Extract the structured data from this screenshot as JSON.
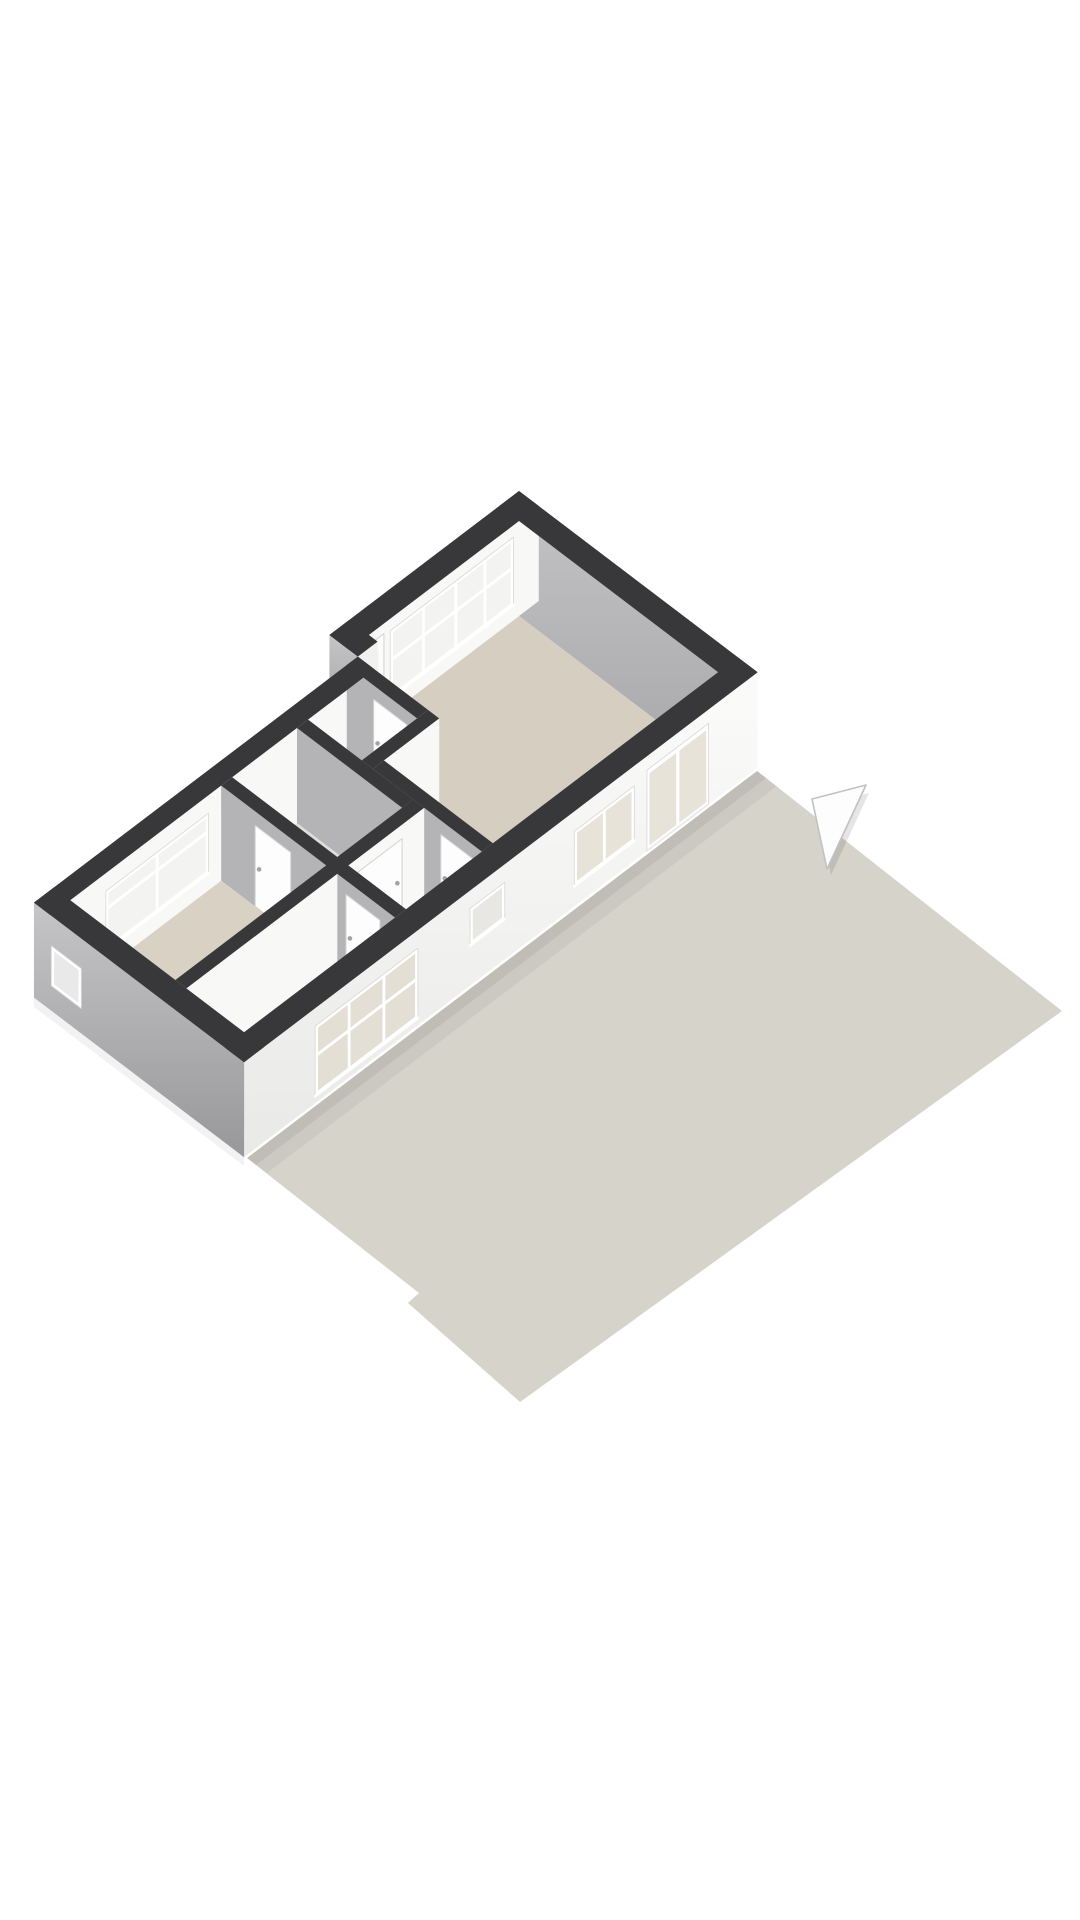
{
  "view": {
    "kind": "floorplan-3d-isometric",
    "background": "#ffffff",
    "width": 1080,
    "height": 1920
  },
  "colors": {
    "wallTop": "#38383a",
    "grayWall": "#b4b4b7",
    "whiteWall": "#f8f8f7",
    "whiteSliver": "#f1f1f0",
    "livingFloor": "#d6cfc1",
    "bedroomFloor": "#d8d1c4",
    "room2Floor": "#d9d2c5",
    "closetFloor": "#dcdbd7",
    "bathFloor": "#dfdedb",
    "hallFloor": "#e3e2de",
    "terrace": "#d5d3ca",
    "glassOutside": "#f3f3f2",
    "glassLiving": "#e8e3d9",
    "glassHall": "#e8e7e3",
    "glassRoom2": "#e4dfd5",
    "glassFrontDoor": "#eef0ef",
    "glassSmall": "#e9e9e9",
    "frame": "#ffffff",
    "frameEdge": "#d7d7d7",
    "doorLeaf": "#fdfdfd",
    "doorEdge": "#d2d2d2",
    "handle": "#a3a3a3",
    "arrowFill": "#fdfdfd",
    "arrowEdge": "#c2c2c2"
  },
  "gradients": {
    "gGrayWall": {
      "from": "#c2c2c4",
      "to": "#a7a7aa"
    },
    "gWhiteFacade": {
      "from": "#fbfbfa",
      "to": "#e9e9e8"
    },
    "gGrayFacade": {
      "from": "#c5c5c7",
      "to": "#98989a"
    }
  },
  "projection": {
    "originX": 519,
    "originY": 491,
    "ux": 0.79,
    "uy": 0.6,
    "wallHeight": 95
  },
  "terrace": {
    "outline": [
      [
        757,
        771
      ],
      [
        1062,
        1011
      ],
      [
        520,
        1402
      ],
      [
        408,
        1303
      ],
      [
        419,
        1293
      ],
      [
        247,
        1158
      ]
    ]
  },
  "shadows": [
    {
      "pts": [
        [
          247,
          1158
        ],
        [
          757,
          771
        ],
        [
          777,
          786
        ],
        [
          267,
          1173
        ]
      ],
      "fill": "rgba(0,0,0,0.045)"
    },
    {
      "pts": [
        [
          247,
          1158
        ],
        [
          757,
          771
        ],
        [
          766,
          778
        ],
        [
          256,
          1165
        ]
      ],
      "fill": "rgba(0,0,0,0.06)"
    },
    {
      "pts": [
        [
          34,
          998
        ],
        [
          244,
          1157
        ],
        [
          244,
          1166
        ],
        [
          34,
          1007
        ]
      ],
      "fill": "rgba(0,0,0,0.05)"
    }
  ],
  "scene": {
    "ops": [
      {
        "op": "floor",
        "name": "living-room-floor",
        "poly": [
          [
            25,
            25
          ],
          [
            277,
            25
          ],
          [
            277,
            310
          ],
          [
            139,
            310
          ],
          [
            139,
            240
          ],
          [
            36,
            240
          ],
          [
            36,
            215
          ],
          [
            25,
            215
          ]
        ],
        "fill": "livingFloor"
      },
      {
        "op": "floor",
        "name": "closet-floor",
        "poly": [
          [
            57,
            254
          ],
          [
            125,
            254
          ],
          [
            125,
            324
          ],
          [
            57,
            324
          ]
        ],
        "fill": "closetFloor"
      },
      {
        "op": "floor",
        "name": "bathroom-floor",
        "poly": [
          [
            57,
            338
          ],
          [
            190,
            338
          ],
          [
            190,
            420
          ],
          [
            57,
            420
          ]
        ],
        "fill": "bathFloor"
      },
      {
        "op": "floor",
        "name": "bedroom-floor",
        "poly": [
          [
            57,
            434
          ],
          [
            190,
            434
          ],
          [
            190,
            625
          ],
          [
            57,
            625
          ]
        ],
        "fill": "bedroomFloor"
      },
      {
        "op": "floor",
        "name": "hall-floor",
        "poly": [
          [
            204,
            324
          ],
          [
            277,
            324
          ],
          [
            277,
            420
          ],
          [
            204,
            420
          ]
        ],
        "fill": "hallFloor"
      },
      {
        "op": "floor",
        "name": "room2-floor",
        "poly": [
          [
            204,
            434
          ],
          [
            277,
            434
          ],
          [
            277,
            625
          ],
          [
            204,
            625
          ]
        ],
        "fill": "room2Floor"
      },
      {
        "op": "fV",
        "name": "living-back-wall",
        "v": 25,
        "u1": 0,
        "u2": 302,
        "z1": 0,
        "z2": 95,
        "fill": "grad:gGrayWall"
      },
      {
        "op": "fU",
        "name": "window-wall",
        "u": 25,
        "v1": 0,
        "v2": 240,
        "z1": 0,
        "z2": 95,
        "fill": "whiteWall"
      },
      {
        "op": "winU",
        "name": "living-window-band",
        "u": 25,
        "v1": 32,
        "v2": 188,
        "z1": 12,
        "z2": 80,
        "glass": "glassOutside",
        "mullions": [
          68,
          105,
          146
        ],
        "transom": 42
      },
      {
        "op": "frontDoor",
        "name": "front-door",
        "u": 25,
        "v1": 196,
        "v2": 238,
        "z1": 10,
        "z2": 95
      },
      {
        "op": "fV",
        "name": "step-wall-exterior",
        "v": 240,
        "u1": 0,
        "u2": 36,
        "z1": 0,
        "z2": 95,
        "fill": "grad:gGrayFacade"
      },
      {
        "op": "fU",
        "name": "step-wall-return",
        "u": 36,
        "v1": 215,
        "v2": 240,
        "z1": 0,
        "z2": 95,
        "fill": "whiteSliver"
      },
      {
        "op": "fU",
        "name": "bedroom-window-wall",
        "u": 57,
        "v1": 240,
        "v2": 650,
        "z1": 0,
        "z2": 95,
        "fill": "whiteWall"
      },
      {
        "op": "winU",
        "name": "bedroom-window",
        "u": 57,
        "v1": 450,
        "v2": 580,
        "z1": 18,
        "z2": 78,
        "glass": "glassOutside",
        "mullions": [
          515
        ],
        "transom": 36
      },
      {
        "op": "fV",
        "name": "wall-w1a",
        "v": 254,
        "u1": 36,
        "u2": 125,
        "z1": 0,
        "z2": 95,
        "fill": "grayWall"
      },
      {
        "op": "doorV",
        "name": "closet-door",
        "v": 254,
        "u1": 70,
        "u2": 112
      },
      {
        "op": "fU",
        "name": "wall-w1a-end",
        "u": 125,
        "v1": 240,
        "v2": 254,
        "z1": 0,
        "z2": 95,
        "fill": "whiteSliver"
      },
      {
        "op": "fU",
        "name": "wall-w1b",
        "u": 139,
        "v1": 240,
        "v2": 324,
        "z1": 0,
        "z2": 95,
        "fill": "whiteWall"
      },
      {
        "op": "fV",
        "name": "wall-w1b-end",
        "v": 324,
        "u1": 125,
        "u2": 139,
        "z1": 0,
        "z2": 95,
        "fill": "grayWall"
      },
      {
        "op": "fV",
        "name": "wall-w4",
        "v": 338,
        "u1": 57,
        "u2": 190,
        "z1": 0,
        "z2": 95,
        "fill": "grayWall"
      },
      {
        "op": "fU",
        "name": "wall-w4-end",
        "u": 190,
        "v1": 324,
        "v2": 338,
        "z1": 0,
        "z2": 95,
        "fill": "whiteSliver"
      },
      {
        "op": "fV",
        "name": "wall-w1c",
        "v": 324,
        "u1": 139,
        "u2": 277,
        "z1": 0,
        "z2": 95,
        "fill": "grayWall"
      },
      {
        "op": "doorV",
        "name": "living-hall-door",
        "v": 324,
        "u1": 225,
        "u2": 268
      },
      {
        "op": "fU",
        "name": "wall-w2-upper",
        "u": 204,
        "v1": 324,
        "v2": 420,
        "z1": 0,
        "z2": 95,
        "fill": "whiteWall"
      },
      {
        "op": "doorU",
        "name": "hall-bath-door",
        "u": 204,
        "v1": 352,
        "v2": 408
      },
      {
        "op": "fV",
        "name": "wall-w2-upper-end",
        "v": 420,
        "u1": 190,
        "u2": 204,
        "z1": 0,
        "z2": 95,
        "fill": "grayWall"
      },
      {
        "op": "fV",
        "name": "wall-w5",
        "v": 434,
        "u1": 57,
        "u2": 277,
        "z1": 0,
        "z2": 95,
        "fill": "grayWall"
      },
      {
        "op": "doorV",
        "name": "bedroom-door",
        "v": 434,
        "u1": 100,
        "u2": 145
      },
      {
        "op": "doorV",
        "name": "room2-door",
        "v": 434,
        "u1": 215,
        "u2": 258
      },
      {
        "op": "fU",
        "name": "wall-w2-lower",
        "u": 204,
        "v1": 434,
        "v2": 625,
        "z1": 0,
        "z2": 95,
        "fill": "whiteWall"
      },
      {
        "op": "fU",
        "name": "facade-southeast",
        "u": 302,
        "v1": 0,
        "v2": 650,
        "z1": 0,
        "z2": 95,
        "fill": "grad:gWhiteFacade"
      },
      {
        "op": "terraceDoor",
        "name": "terrace-entrance-door",
        "u": 302,
        "v1": 62,
        "v2": 140,
        "z1": 18,
        "z2": 93,
        "split": 101,
        "glass": "glassLiving"
      },
      {
        "op": "winU",
        "name": "living-facade-window",
        "u": 302,
        "v1": 156,
        "v2": 232,
        "z1": 20,
        "z2": 75,
        "glass": "glassLiving",
        "mullions": [
          194
        ],
        "transom": null
      },
      {
        "op": "winU",
        "name": "hall-facade-window",
        "u": 302,
        "v1": 320,
        "v2": 364,
        "z1": 18,
        "z2": 55,
        "glass": "glassHall",
        "mullions": [],
        "transom": null
      },
      {
        "op": "winU",
        "name": "room2-facade-window",
        "u": 302,
        "v1": 430,
        "v2": 560,
        "z1": 18,
        "z2": 88,
        "glass": "glassRoom2",
        "mullions": [
          473,
          517
        ],
        "transom": 48
      },
      {
        "op": "fV",
        "name": "facade-southwest",
        "v": 650,
        "u1": 36,
        "u2": 302,
        "z1": 0,
        "z2": 95,
        "fill": "grad:gGrayFacade"
      },
      {
        "op": "winV",
        "name": "small-facade-window",
        "v": 650,
        "u1": 58,
        "u2": 96,
        "z1": 30,
        "z2": 70,
        "glass": "glassSmall",
        "mullions": [],
        "transom": null
      },
      {
        "op": "top",
        "name": "wall-top",
        "u1": 0,
        "u2": 302,
        "v1": 0,
        "v2": 25
      },
      {
        "op": "top",
        "name": "wall-top",
        "u1": 277,
        "u2": 302,
        "v1": 0,
        "v2": 650
      },
      {
        "op": "top",
        "name": "wall-top",
        "u1": 36,
        "u2": 302,
        "v1": 625,
        "v2": 650
      },
      {
        "op": "top",
        "name": "wall-top",
        "u1": 36,
        "u2": 57,
        "v1": 240,
        "v2": 650
      },
      {
        "op": "top",
        "name": "wall-top",
        "u1": 0,
        "u2": 25,
        "v1": 0,
        "v2": 240
      },
      {
        "op": "top",
        "name": "wall-top",
        "u1": 0,
        "u2": 36,
        "v1": 215,
        "v2": 240
      },
      {
        "op": "top",
        "name": "wall-top",
        "u1": 36,
        "u2": 125,
        "v1": 240,
        "v2": 254
      },
      {
        "op": "top",
        "name": "wall-top",
        "u1": 125,
        "u2": 139,
        "v1": 240,
        "v2": 324
      },
      {
        "op": "top",
        "name": "wall-top",
        "u1": 139,
        "u2": 277,
        "v1": 310,
        "v2": 324
      },
      {
        "op": "top",
        "name": "wall-top",
        "u1": 57,
        "u2": 190,
        "v1": 324,
        "v2": 338
      },
      {
        "op": "top",
        "name": "wall-top",
        "u1": 190,
        "u2": 204,
        "v1": 324,
        "v2": 625
      },
      {
        "op": "top",
        "name": "wall-top",
        "u1": 57,
        "u2": 277,
        "v1": 420,
        "v2": 434
      }
    ]
  },
  "arrow": {
    "shadow": [
      [
        817,
        807
      ],
      [
        869,
        793
      ],
      [
        831,
        875
      ]
    ],
    "main": [
      [
        812,
        799
      ],
      [
        866,
        785
      ],
      [
        827,
        869
      ]
    ]
  }
}
